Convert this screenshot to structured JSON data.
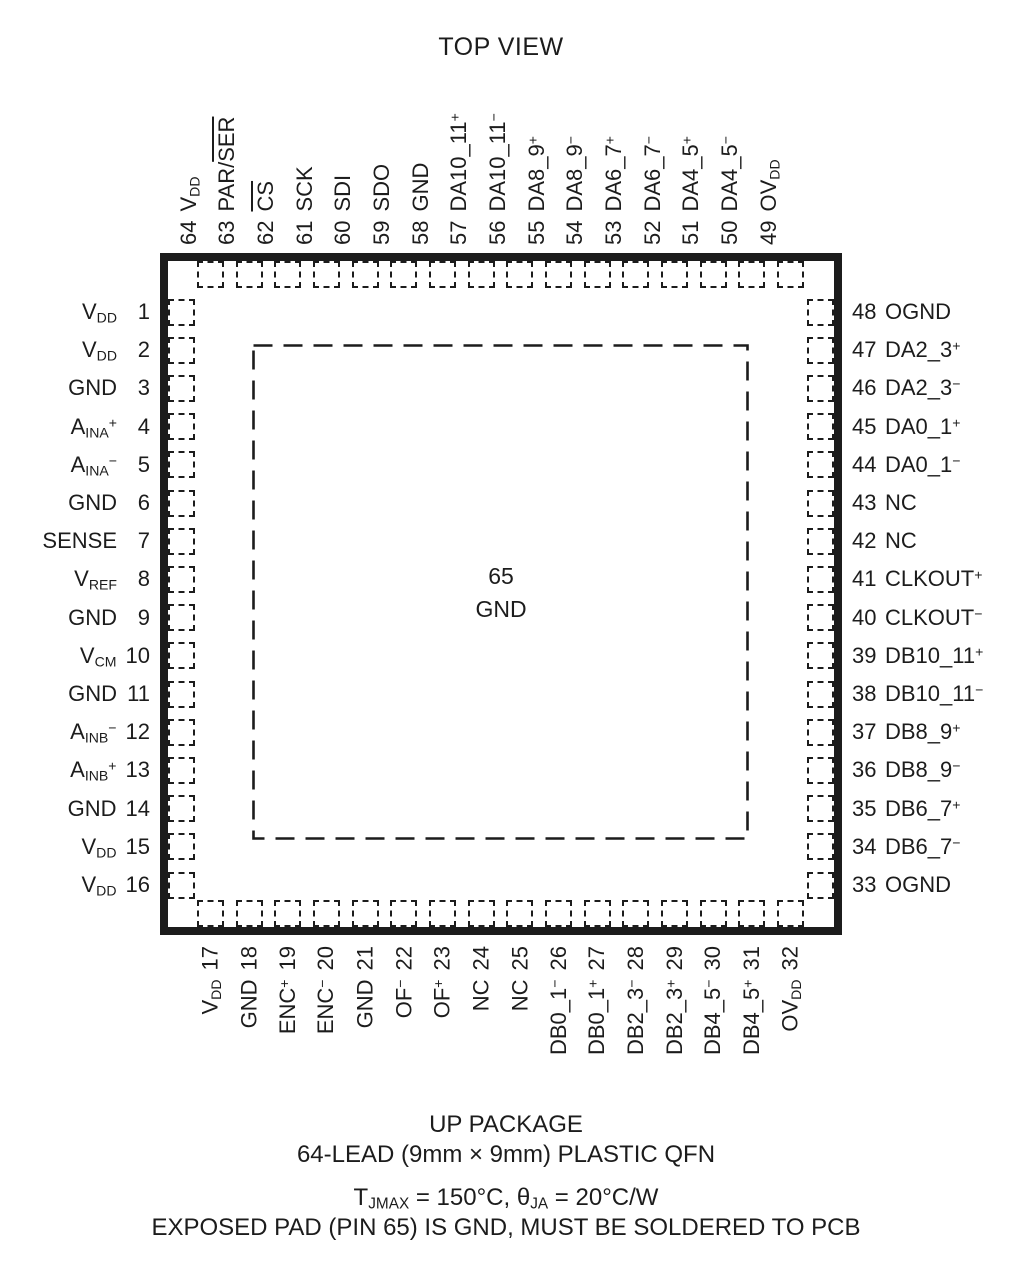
{
  "title": "TOP VIEW",
  "package": {
    "center_pin": {
      "number": "65",
      "name": "GND"
    },
    "pins": {
      "top": [
        {
          "num": "64",
          "label": "V~DD~"
        },
        {
          "num": "63",
          "label": "PAR/|SER|"
        },
        {
          "num": "62",
          "label": "|CS|"
        },
        {
          "num": "61",
          "label": "SCK"
        },
        {
          "num": "60",
          "label": "SDI"
        },
        {
          "num": "59",
          "label": "SDO"
        },
        {
          "num": "58",
          "label": "GND"
        },
        {
          "num": "57",
          "label": "DA10_11^+^"
        },
        {
          "num": "56",
          "label": "DA10_11^−^"
        },
        {
          "num": "55",
          "label": "DA8_9^+^"
        },
        {
          "num": "54",
          "label": "DA8_9^−^"
        },
        {
          "num": "53",
          "label": "DA6_7^+^"
        },
        {
          "num": "52",
          "label": "DA6_7^−^"
        },
        {
          "num": "51",
          "label": "DA4_5^+^"
        },
        {
          "num": "50",
          "label": "DA4_5^−^"
        },
        {
          "num": "49",
          "label": "OV~DD~"
        }
      ],
      "left": [
        {
          "num": "1",
          "label": "V~DD~"
        },
        {
          "num": "2",
          "label": "V~DD~"
        },
        {
          "num": "3",
          "label": "GND"
        },
        {
          "num": "4",
          "label": "A~INA~^+^"
        },
        {
          "num": "5",
          "label": "A~INA~^−^"
        },
        {
          "num": "6",
          "label": "GND"
        },
        {
          "num": "7",
          "label": "SENSE"
        },
        {
          "num": "8",
          "label": "V~REF~"
        },
        {
          "num": "9",
          "label": "GND"
        },
        {
          "num": "10",
          "label": "V~CM~"
        },
        {
          "num": "11",
          "label": "GND"
        },
        {
          "num": "12",
          "label": "A~INB~^−^"
        },
        {
          "num": "13",
          "label": "A~INB~^+^"
        },
        {
          "num": "14",
          "label": "GND"
        },
        {
          "num": "15",
          "label": "V~DD~"
        },
        {
          "num": "16",
          "label": "V~DD~"
        }
      ],
      "right": [
        {
          "num": "48",
          "label": "OGND"
        },
        {
          "num": "47",
          "label": "DA2_3^+^"
        },
        {
          "num": "46",
          "label": "DA2_3^−^"
        },
        {
          "num": "45",
          "label": "DA0_1^+^"
        },
        {
          "num": "44",
          "label": "DA0_1^−^"
        },
        {
          "num": "43",
          "label": "NC"
        },
        {
          "num": "42",
          "label": "NC"
        },
        {
          "num": "41",
          "label": "CLKOUT^+^"
        },
        {
          "num": "40",
          "label": "CLKOUT^−^"
        },
        {
          "num": "39",
          "label": "DB10_11^+^"
        },
        {
          "num": "38",
          "label": "DB10_11^−^"
        },
        {
          "num": "37",
          "label": "DB8_9^+^"
        },
        {
          "num": "36",
          "label": "DB8_9^−^"
        },
        {
          "num": "35",
          "label": "DB6_7^+^"
        },
        {
          "num": "34",
          "label": "DB6_7^−^"
        },
        {
          "num": "33",
          "label": "OGND"
        }
      ],
      "bottom": [
        {
          "num": "17",
          "label": "V~DD~"
        },
        {
          "num": "18",
          "label": "GND"
        },
        {
          "num": "19",
          "label": "ENC^+^"
        },
        {
          "num": "20",
          "label": "ENC^−^"
        },
        {
          "num": "21",
          "label": "GND"
        },
        {
          "num": "22",
          "label": "OF^−^"
        },
        {
          "num": "23",
          "label": "OF^+^"
        },
        {
          "num": "24",
          "label": "NC"
        },
        {
          "num": "25",
          "label": "NC"
        },
        {
          "num": "26",
          "label": "DB0_1^−^"
        },
        {
          "num": "27",
          "label": "DB0_1^+^"
        },
        {
          "num": "28",
          "label": "DB2_3^−^"
        },
        {
          "num": "29",
          "label": "DB2_3^+^"
        },
        {
          "num": "30",
          "label": "DB4_5^−^"
        },
        {
          "num": "31",
          "label": "DB4_5^+^"
        },
        {
          "num": "32",
          "label": "OV~DD~"
        }
      ]
    }
  },
  "footer": {
    "line1": "UP PACKAGE",
    "line2": "64-LEAD (9mm × 9mm) PLASTIC QFN",
    "line3": "T~JMAX~ = 150°C, θ~JA~ = 20°C/W",
    "line4": "EXPOSED PAD (PIN 65) IS GND, MUST BE SOLDERED TO PCB"
  },
  "colors": {
    "ink": "#1c1c1c",
    "background": "#ffffff"
  }
}
